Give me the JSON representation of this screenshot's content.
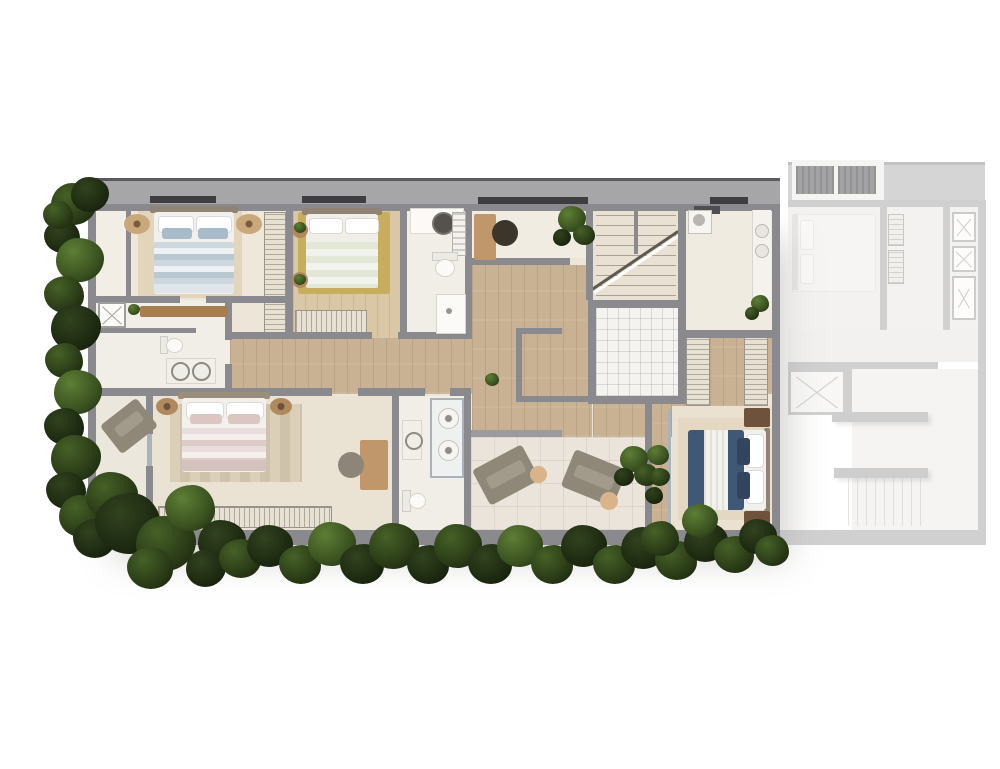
{
  "scene": {
    "type": "architectural-floor-plan",
    "view": "top-down-rendered",
    "units": [
      {
        "id": "main-unit",
        "state": "highlighted"
      },
      {
        "id": "adjacent-unit",
        "state": "faded"
      }
    ]
  },
  "palette": {
    "white": "#ffffff",
    "wall": "#8a898d",
    "wallLight": "#a6a5a7",
    "slabEdge": "#5b5a5e",
    "window": "#3e3d42",
    "floorBase": "#ece5d8",
    "floorLight": "#f1ede5",
    "wood": "#c9b293",
    "woodLight": "#d9c7a6",
    "bathFloor": "#f1eee8",
    "terrace": "#eae4da",
    "tile": "#f5f3ef",
    "rug": "#e2d5bc",
    "rugStripeA": "#dbcfb9",
    "rugStripeB": "#cfc2aa",
    "mustardRug": "#c9ad5f",
    "bedWhite": "#f1f0ed",
    "headboard": "#8f8375",
    "blueA": "#cdd7de",
    "blueB": "#b9c7d1",
    "blushA": "#e9dedd",
    "blushB": "#dccbc6",
    "sage": "#e3e7d6",
    "navy": "#3e5876",
    "navyDark": "#32455c",
    "woodFurn": "#b0895e",
    "deskWood": "#c0976a",
    "dresser": "#a87e51",
    "darkWoodNs": "#6e523c",
    "chairDark": "#3c352c",
    "chairGray": "#8d8577",
    "taupe": "#8f8878",
    "taupePad": "#a29a8a",
    "sideTable": "#d9b48b",
    "glass": "#aab3ba",
    "fixtureWhite": "#fbfaf7",
    "fixtureLine": "#d5d2cc",
    "basinDark": "#55524e",
    "ac": "#515157",
    "fadedWall": "#a7a6a9",
    "fadedFloor": "#ebe7e1",
    "fadedFurn": "#efece7"
  },
  "rooms": [
    {
      "id": "bedroom-1",
      "features": [
        "double-bed-blue",
        "nightstand-poufs",
        "wardrobe-strip",
        "dresser"
      ]
    },
    {
      "id": "bedroom-2",
      "features": [
        "double-bed-sage",
        "mustard-rug",
        "round-side-tables",
        "wardrobe"
      ]
    },
    {
      "id": "bathroom-top",
      "features": [
        "vanity-basin",
        "mirror-cabinet",
        "toilet",
        "shower-tray"
      ]
    },
    {
      "id": "study",
      "features": [
        "desk",
        "chair",
        "plant"
      ]
    },
    {
      "id": "staircase",
      "features": [
        "two-flights",
        "break-line"
      ]
    },
    {
      "id": "laundry",
      "features": [
        "counter",
        "appliance",
        "plant"
      ]
    },
    {
      "id": "bathroom-left",
      "features": [
        "washer-box",
        "toilet",
        "double-vanity"
      ]
    },
    {
      "id": "hallway",
      "features": [
        "wood-floor"
      ]
    },
    {
      "id": "shower-room",
      "features": [
        "white-tile"
      ]
    },
    {
      "id": "master-bedroom",
      "features": [
        "double-bed-blush",
        "striped-rug",
        "wardrobe",
        "desk",
        "chair"
      ]
    },
    {
      "id": "master-bathroom",
      "features": [
        "glass-shower-two-heads",
        "toilet",
        "vanity"
      ]
    },
    {
      "id": "balcony-left",
      "features": [
        "lounge-chair"
      ]
    },
    {
      "id": "terrace",
      "features": [
        "two-lounge-chairs",
        "side-tables",
        "plant"
      ]
    },
    {
      "id": "walk-in-closet",
      "features": [
        "two-hatched-wardrobes",
        "wood-path"
      ]
    },
    {
      "id": "bedroom-3",
      "features": [
        "double-bed-navy",
        "nightstands",
        "rug",
        "planted-balcony"
      ]
    }
  ],
  "adjacent_unit": {
    "id": "adjacent-unit",
    "features": [
      "roof-slab",
      "two-ac-condensers",
      "bedroom-bed",
      "hatched-closets",
      "x-wardrobe-boxes",
      "elevator-shaft",
      "corridor",
      "stair-flight",
      "counters"
    ]
  },
  "foliage": {
    "blobs": [
      [
        74,
        206,
        46,
        1
      ],
      [
        62,
        238,
        36,
        0
      ],
      [
        80,
        262,
        48,
        2
      ],
      [
        64,
        296,
        40,
        1
      ],
      [
        76,
        330,
        50,
        0
      ],
      [
        64,
        362,
        38,
        1
      ],
      [
        78,
        394,
        48,
        2
      ],
      [
        64,
        428,
        40,
        0
      ],
      [
        76,
        460,
        50,
        1
      ],
      [
        66,
        492,
        40,
        0
      ],
      [
        82,
        518,
        46,
        1
      ],
      [
        94,
        540,
        42,
        0
      ],
      [
        90,
        196,
        38,
        0
      ],
      [
        58,
        216,
        30,
        1
      ],
      [
        112,
        498,
        52,
        1
      ],
      [
        128,
        526,
        66,
        0
      ],
      [
        166,
        546,
        60,
        1
      ],
      [
        190,
        510,
        50,
        2
      ],
      [
        222,
        544,
        48,
        0
      ],
      [
        150,
        570,
        46,
        1
      ],
      [
        206,
        570,
        40,
        0
      ],
      [
        240,
        560,
        42,
        1
      ],
      [
        270,
        548,
        46,
        0
      ],
      [
        300,
        566,
        42,
        1
      ],
      [
        332,
        546,
        48,
        2
      ],
      [
        362,
        566,
        44,
        0
      ],
      [
        394,
        548,
        50,
        1
      ],
      [
        428,
        566,
        42,
        0
      ],
      [
        458,
        548,
        48,
        1
      ],
      [
        490,
        566,
        44,
        0
      ],
      [
        520,
        548,
        46,
        2
      ],
      [
        552,
        566,
        42,
        1
      ],
      [
        584,
        548,
        46,
        0
      ],
      [
        614,
        566,
        42,
        1
      ],
      [
        644,
        550,
        46,
        0
      ],
      [
        676,
        562,
        42,
        1
      ],
      [
        706,
        544,
        44,
        0
      ],
      [
        734,
        556,
        40,
        1
      ],
      [
        758,
        538,
        38,
        0
      ],
      [
        772,
        552,
        34,
        1
      ],
      [
        700,
        522,
        36,
        2
      ],
      [
        660,
        540,
        38,
        1
      ],
      [
        634,
        460,
        28,
        2
      ],
      [
        646,
        476,
        24,
        1
      ],
      [
        624,
        478,
        20,
        0
      ],
      [
        658,
        456,
        22,
        2
      ],
      [
        660,
        478,
        20,
        1
      ],
      [
        654,
        496,
        18,
        0
      ],
      [
        572,
        220,
        28,
        2
      ],
      [
        584,
        236,
        22,
        1
      ],
      [
        562,
        238,
        18,
        0
      ],
      [
        760,
        304,
        18,
        2
      ],
      [
        752,
        314,
        14,
        1
      ],
      [
        492,
        380,
        14,
        2
      ],
      [
        134,
        310,
        12,
        2
      ],
      [
        300,
        228,
        12,
        2
      ],
      [
        300,
        280,
        12,
        2
      ]
    ]
  }
}
